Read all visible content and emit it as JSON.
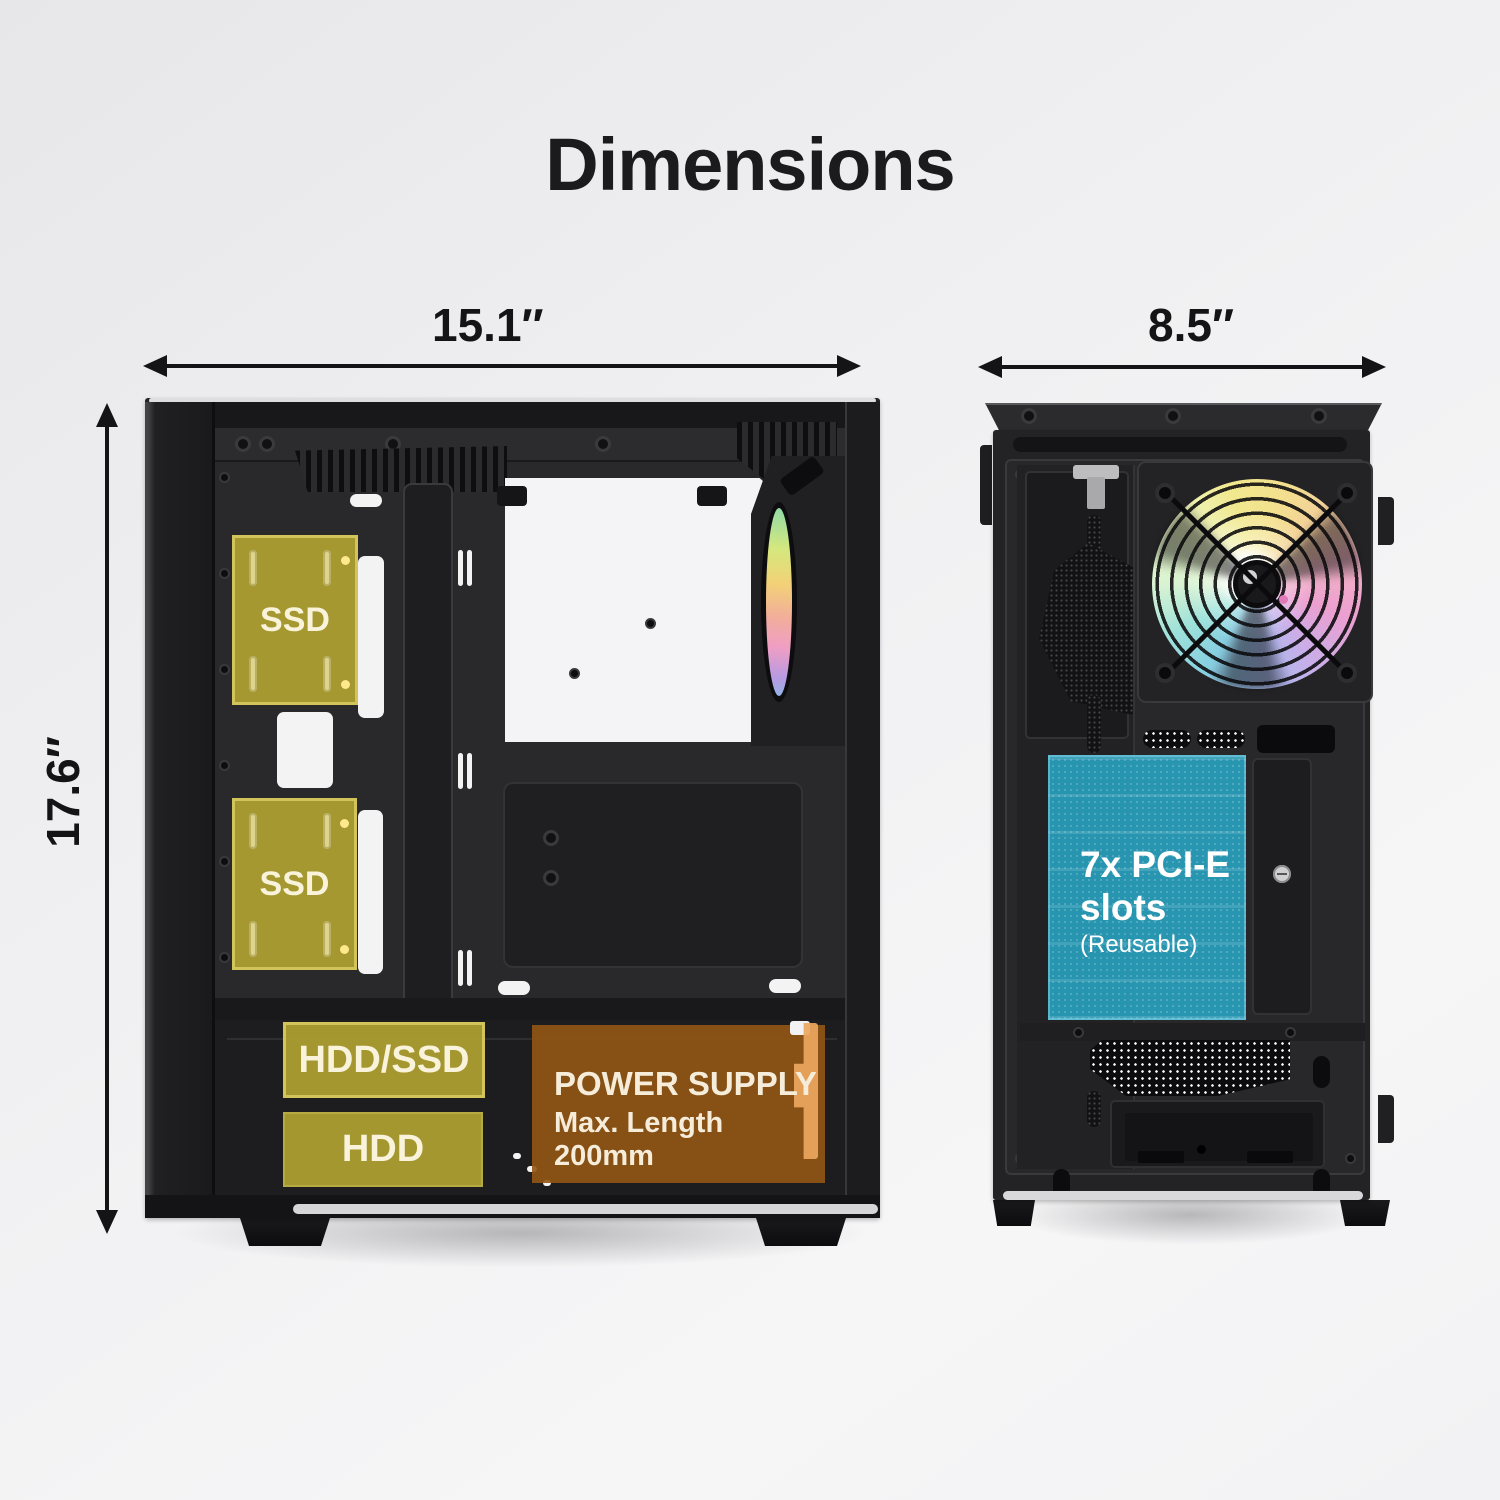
{
  "title": "Dimensions",
  "side_view": {
    "width_label": "15.1″",
    "height_label": "17.6″",
    "bays": {
      "ssd_top": "SSD",
      "ssd_bottom": "SSD",
      "hdd_ssd": "HDD/SSD",
      "hdd": "HDD"
    },
    "psu": {
      "title": "POWER SUPPLY",
      "subtitle": "Max. Length 200mm"
    }
  },
  "rear_view": {
    "width_label": "8.5″",
    "pcie": {
      "line1": "7x PCI-E",
      "line2": "slots",
      "line3": "(Reusable)"
    }
  },
  "icons": {
    "dimension_arrow": "double-headed-arrow",
    "fan": "rgb-fan"
  },
  "colors": {
    "background": "#efeff1",
    "case_black": "#232325",
    "drive_bay_olive": "#afa032",
    "psu_orange": "#945713",
    "pcie_teal": "#299cb8",
    "annotation_text": "#141416",
    "overlay_text": "#f8f3da"
  }
}
